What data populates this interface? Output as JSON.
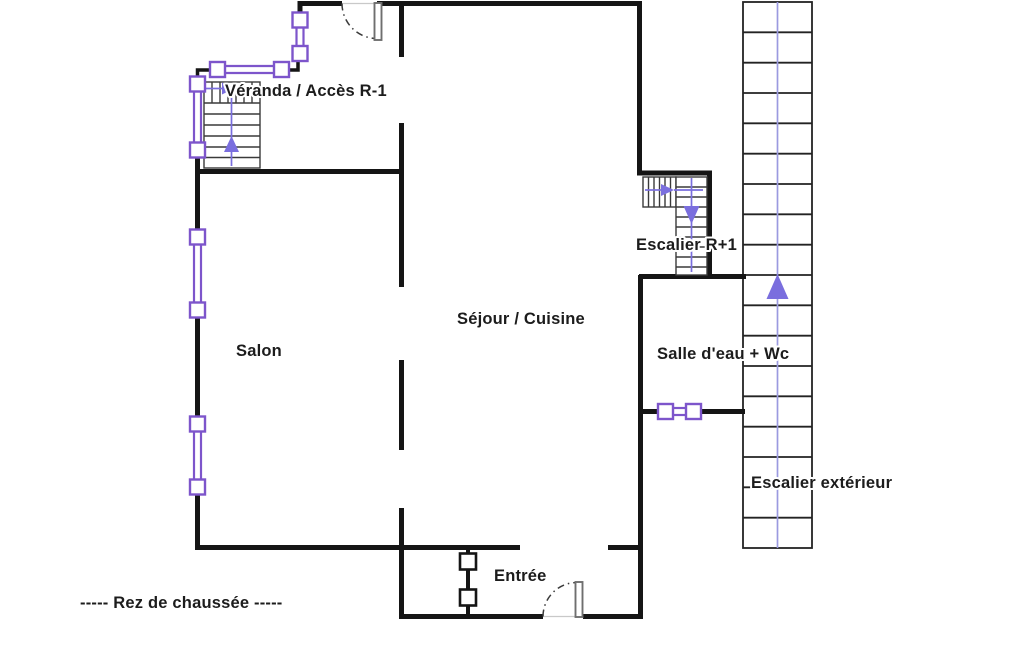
{
  "floorplan": {
    "caption": "-----  Rez de chaussée  -----",
    "labels": {
      "veranda": "Véranda / Accès R-1",
      "salon": "Salon",
      "sejour_cuisine": "Séjour / Cuisine",
      "escalier_r1": "Escalier R+1",
      "salle_eau_wc": "Salle d'eau + Wc",
      "entree": "Entrée",
      "escalier_exterieur": "Escalier extérieur"
    },
    "colors": {
      "walls": "#151515",
      "window_frames": "#7d55cb",
      "direction_arrows": "#7a6ede",
      "stair_treads": "#3a3a3a",
      "exterior_stair_guide": "#9b9ae0",
      "door_leaf": "#6f6f6f",
      "label_text": "#1c1c1c",
      "background": "#ffffff"
    }
  }
}
